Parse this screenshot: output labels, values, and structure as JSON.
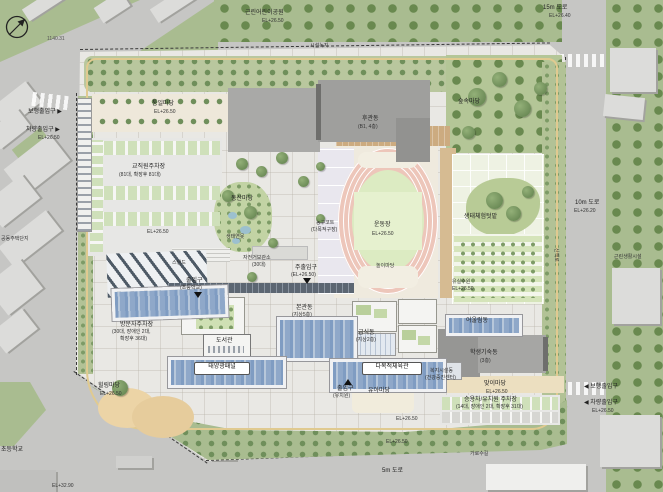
{
  "type": "architectural-site-plan",
  "language": "ko",
  "colors": {
    "road": "#c6c6c4",
    "context_green": "#a9bc90",
    "site_paving": "#e9e8e4",
    "tree": "#6f8f5b",
    "path_yellow": "#e0ca90",
    "track_ring": "#edc6ba",
    "track_infield": "#dcebc2",
    "solar_panel": "#7f9cc2",
    "building_gray": "#a6a6a4",
    "plaza_beige": "#ecdfc0"
  },
  "labels": {
    "park_name": "근린어린이공원",
    "park_el": "EL+26.50",
    "road_15m": "15m 도로",
    "road_15m_el": "EL+26.40",
    "dim_topleft": "1140.31",
    "green_strip": "시설녹지",
    "entry_ped_left": "보행출입구 ▶",
    "entry_veh_left": "차량출입구 ▶",
    "entry_veh_left_el": "EL+26.50",
    "plaza_tongil": "통일마당",
    "plaza_tongil_el": "EL+26.50",
    "parking_nw": "교직원주차장",
    "parking_nw_count": "(81대, 확장후 81대)",
    "el_nw": "EL+26.50",
    "bldg_rear": "후관동",
    "bldg_rear_fl": "(B1, 4층)",
    "plaza_forest": "숲속마당",
    "plaza_dongsan": "동산마당",
    "pond_eco": "생태연못",
    "court_basket": "농구코트",
    "court_basket_sub": "(다목적구장)",
    "field_name": "운동장",
    "field_el": "EL+26.50",
    "play_area": "놀이마당",
    "garden_eco": "생태체험텃밭",
    "orchard": "유실수원",
    "orchard_el": "EL+26.50",
    "road_10m": "10m 도로",
    "road_10m_el": "EL+26.20",
    "trail": "산책로",
    "stand": "스탠드",
    "bike_parking": "자전거보관소",
    "bike_count": "(30대)",
    "entry_main": "주출입구",
    "entry_main_el": "(EL+26.50)",
    "entry_elem": "출입구",
    "entry_elem_sub": "(초등학교)",
    "bldg_main": "본관동",
    "bldg_main_fl": "(지상5층)",
    "bldg_cafeteria": "급식동",
    "bldg_cafeteria_fl": "(지상2층)",
    "bldg_library": "도서관",
    "solar_panel_tag": "태양광패널",
    "bldg_gym_tag": "다목적체육관",
    "parking_sw": "방문자주차장",
    "parking_sw_count": "(30대, 장애인 2대,",
    "parking_sw_count2": "확장후 36대)",
    "plaza_healing": "힐링마당",
    "plaza_healing_el": "EL+26.50",
    "entry_kinder": "출입구",
    "entry_kinder_sub": "(유치원)",
    "plaza_child": "유아마당",
    "el_south1": "EL+26.50",
    "el_south2": "EL+26.50",
    "welfare": "복지시설동",
    "welfare_sub": "(건강증진센터)",
    "bldg_dorm": "학생기숙동",
    "bldg_dorm_fl": "(3층)",
    "bldg_eoullim": "어울림동",
    "plaza_welcome": "맞이마당",
    "plaza_welcome_el": "EL+26.50",
    "parking_se": "승용차/유치원 주차장",
    "parking_se_count": "(14대, 장애인 2대, 확장후 31대)",
    "entry_ped_right": "◀ 보행출입구",
    "entry_veh_right": "◀ 차량출입구",
    "entry_veh_right_el": "EL+26.50",
    "road_5m": "5m 도로",
    "el_bottom_left": "EL+32.90",
    "school_adj": "초등학교",
    "apt_adj": "공동주택단지",
    "retail_adj": "근린생활시설",
    "stream": "가로수길"
  }
}
